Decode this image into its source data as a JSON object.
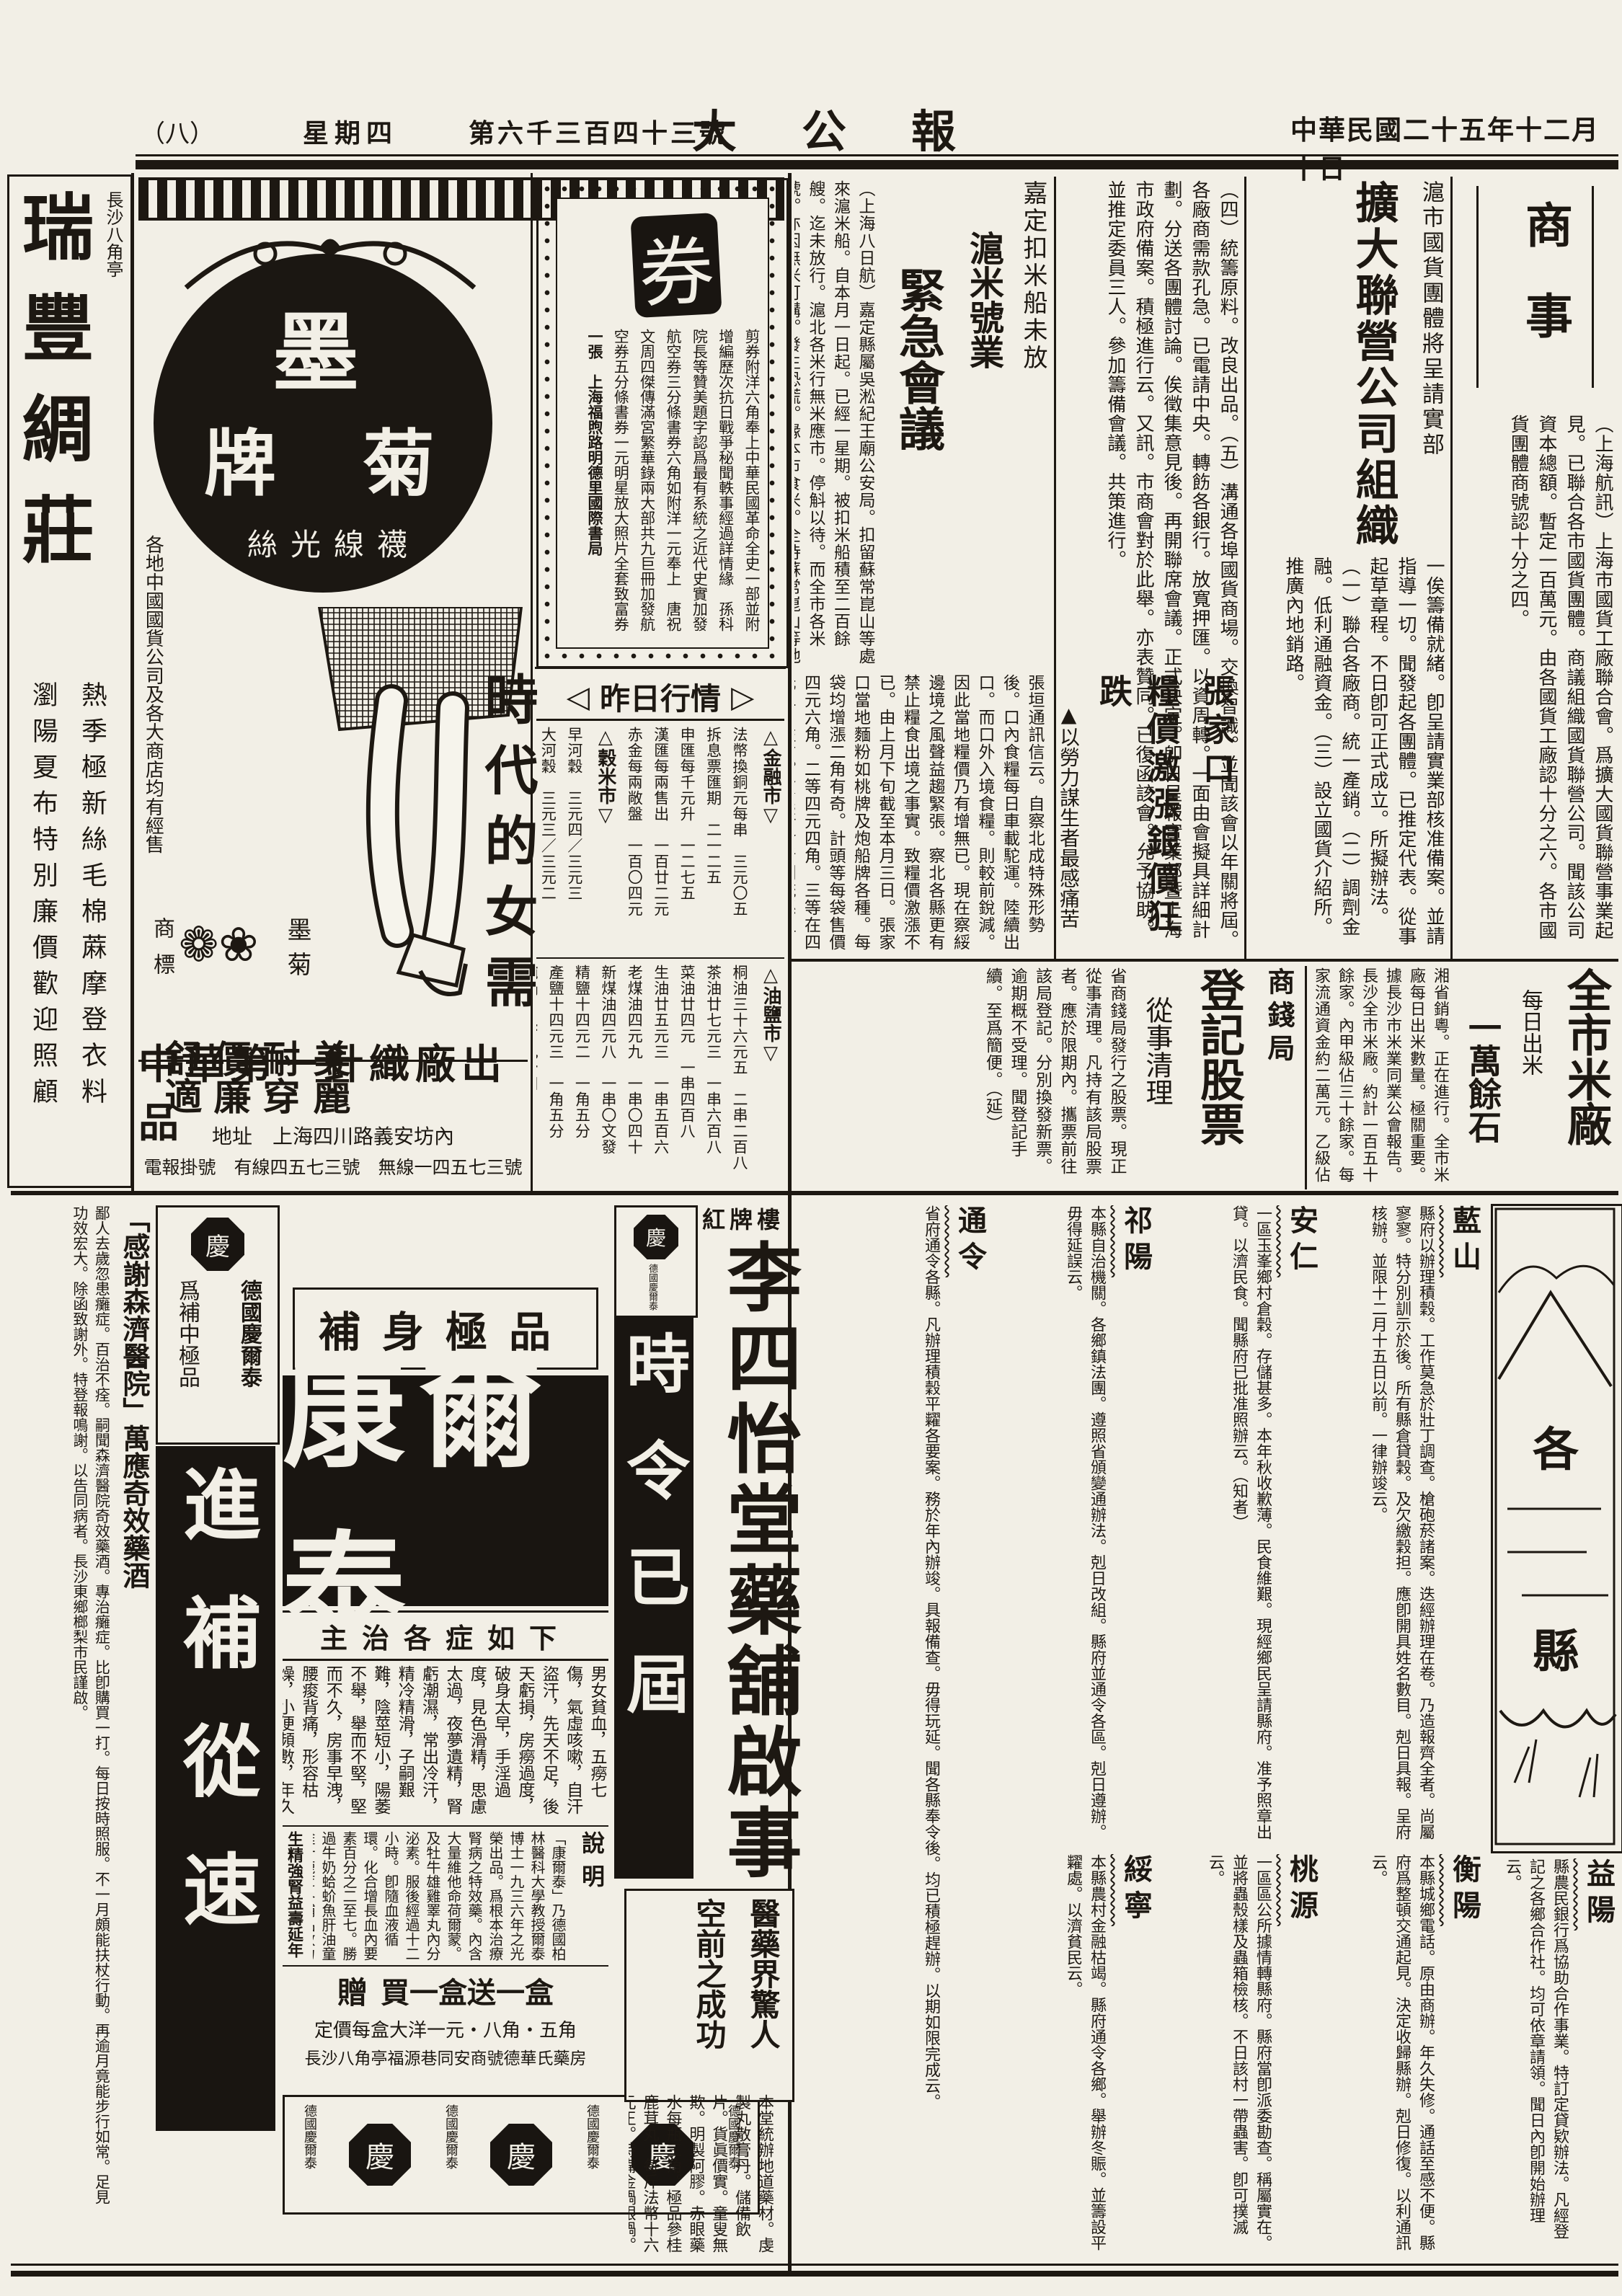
{
  "masthead": {
    "date": "中華民國二十五年十二月十日",
    "title": "大公報",
    "issue": "第六千三百四十三號",
    "weekday": "星期四",
    "page_no": "（八）"
  },
  "news": {
    "section_label": "商事",
    "guohuo": {
      "kicker": "滬市國貨團體將呈請實部",
      "headline": "擴大聯營公司組織",
      "body1": "（上海航訊）上海市國貨工廠聯合會。爲擴大國貨聯營事業起見。已聯合各市國貨團體。商議組織國貨聯營公司。聞該公司資本總額。暫定一百萬元。由各國貨工廠認十分之六。各市國貨團體商號認十分之四。",
      "body2": "一俟籌備就緒。卽呈請實業部核准備案。並請指導一切。聞發起各團體。已推定代表。從事起草章程。不日卽可正式成立。所擬辦法。（一）聯合各廠商。統一產銷。（二）調劑金融。低利通融資金。（三）設立國貨介紹所。推廣內地銷路。",
      "body3": "（四）統籌原料。改良出品。（五）溝通各埠國貨商場。交換智識。並聞該會以年關將屆。各廠商需款孔急。已電請中央。轉飭各銀行。放寬押匯。以資周轉。一面由會擬具詳細計劃。分送各團體討論。俟徵集意見後。再開聯席會議。正式決定。卽日呈報實業部暨上海市政府備案。積極進行云。又訊。市商會對於此舉。亦表贊同。已復函該會。允予協助。並推定委員三人。參加籌備會議。共策進行。"
    },
    "jiading": {
      "kicker": "嘉定扣米船未放",
      "head1": "滬米號業",
      "head2": "緊急會議",
      "body": "（上海八日航）嘉定縣屬吳淞紀王廟公安局。扣留蘇常崑山等處來滬米船。自本月一日起。已經一星期。被扣米船積至二百餘艘。迄未放行。滬北各米行無米應市。停斛以待。而全市各米號。亦因無米可購。發生恐慌。緣本市食米。全恃蘇常崑山等地源源運濟。米號向行家躉進。轉應門市之需。茲聞鐵交部代表。曁米業等代表顧馨一陸槃生蔣石稚等。於今晨乘京滬早車赴鎮。向省政府請願。請爲公決放行。以維民食云。"
    },
    "zhangjiakou": {
      "kicker": "張家口",
      "headline": "糧價激漲銀價狂跌",
      "deck": "▲以勞力謀生者最感痛苦",
      "body": "張垣通訊信云。自察北成特殊形勢後。口內食糧每日車載駝運。陸續出口。而口外入境食糧。則較前銳減。因此當地糧價乃有增無已。現在察綏邊境之風聲益趨緊張。察北各縣更有禁止糧食出境之事實。致糧價激漲不已。由上月下旬截至本月三日。張家口當地麵粉如桃牌及炮船牌各種。每袋均增漲二角有奇。計頭等每袋售價四元六角。二等四元四角。三等在四元二角左右。貧民所食者則統係粗糧。如小米蕎麵及玉米麵等。現亦增漲不已。至於銀元。每元換銅子四百文。較前跌落甚鉅。一般以勞力謀生活者。每日辛勤所入。卽僅可餬口。有室家者。則不能免凍餒矣。"
    },
    "michang": {
      "headline": "全市米廠",
      "kicker": "每日出米",
      "sub": "一萬餘石",
      "body": "湘省銷粵。正在進行。全市米廠每日出米數量。極關重要。據長沙市米業同業公會報告。長沙全市米廠。約計一百五十餘家。內甲級佔三十餘家。每家流通資金約二萬元。乙級佔七十餘家。每家流動資金一萬元。丙級佔五十餘家。每家五千餘元。全市米廠每日儘日夜之力。可出米一萬六千餘石。大部份銷場以滬漢爲最。本市每日銷售二千石上下。本月份因滬漢粵銷場活潑。故平均每日約出米一萬石左右。（廷）"
    },
    "shangqianju": {
      "kicker": "商錢局",
      "headline": "登記股票",
      "deck": "從事清理",
      "body": "省商錢局發行之股票。現正從事清理。凡持有該局股票者。應於限期內。攜票前往該局登記。分別換發新票。逾期概不受理。聞登記手續。至爲簡便。（延）"
    }
  },
  "market": {
    "marker_left": "◁",
    "title": "昨日行情",
    "marker_right": "▷",
    "sections": [
      {
        "name": "△金融市▽",
        "rows": [
          "法幣換銅元每串　三元〇五",
          "拆息票匯期　二一二五",
          "申匯每千元升　一二七五",
          "漢匯每兩售出　一百廿二元",
          "赤金每兩敞盤　一百〇四元"
        ]
      },
      {
        "name": "△穀米市▽",
        "rows": [
          "早河穀　三元四／三元三",
          "大河穀　三元三／三元二",
          "中穀　石三元三／三元二",
          "上米　七元六／七元四",
          "齊米　六元四／五元六",
          "糯米　八元四／八元二",
          "機米　八元四／八元二"
        ]
      },
      {
        "name": "△油鹽市▽",
        "rows": [
          "桐油三十六元五　二串二百八",
          "茶油廿七元三　一串六百八",
          "菜油廿四元　一串四百八",
          "生油廿五元三　一串五百六",
          "老煤油四元九　一串〇四十",
          "新煤油四元八　一串〇文發",
          "精鹽十四元二　一角五分",
          "產鹽十四元三　一角五分"
        ]
      }
    ],
    "footer_rows": [
      "純鍋　五百九十四",
      "鍋卷　七元三百二",
      "生鍋　無市"
    ]
  },
  "coupon": {
    "stamp": "券",
    "lines": [
      "剪券附洋六角奉上中華民國革命全史一部並附",
      "增編歷次抗日戰爭秘聞軼事經過詳情緣　孫科",
      "院長等贊美題字認爲最有系統之近代史實加發",
      "航空券三分條書券六角如附洋一元奉上　唐祝",
      "文周四傑傳滿宮繁華錄兩大部共九巨冊加發航",
      "空券五分條書券一元明星放大照片全套致富券",
      "一張　上海福煦路明德里國際書局"
    ]
  },
  "counties": {
    "header": "各縣",
    "items": [
      {
        "name": "藍山",
        "body": "縣府以辦理積穀。工作莫急於壯丁調查。槍砲菸諸案。迭經辦理在卷。乃造報齊全者。尚屬寥寥。特分別訓示於後。所有縣倉貸穀。及欠繳穀担。應卽開具姓名數目。剋日具報。呈府核辦。並限十二月十五日以前。一律辦竣云。"
      },
      {
        "name": "安仁",
        "body": "一區玉峯鄉村倉穀。存儲甚多。本年秋收歉薄。民食維艱。現經鄉民呈請縣府。准予照章出貸。以濟民食。聞縣府已批准照辦云。（知者）"
      },
      {
        "name": "祁陽",
        "body": "本縣自治機關。各鄉鎮法團。遵照省頒變通辦法。剋日改組。縣府並通令各區。剋日遵辦。毋得延誤云。"
      },
      {
        "name": "通令",
        "body": "省府通令各縣。凡辦理積穀平糶各要案。務於年內辦竣。具報備查。毋得玩延。聞各縣奉令後。均已積極趕辦。以期如限完成云。"
      },
      {
        "name": "益陽",
        "body": "縣農民銀行爲協助合作事業。特訂定貸欵辦法。凡經登記之各鄉合作社。均可依章請領。聞日內卽開始辦理云。"
      },
      {
        "name": "衡陽",
        "body": "本縣城鄉電話。原由商辦。年久失修。通話至感不便。縣府爲整頓交通起見。決定收歸縣辦。剋日修復。以利通訊云。"
      },
      {
        "name": "桃源",
        "body": "一區區公所據情轉縣府。縣府當卽派委勘查。稱屬實在。並將蟲殼樣及蟲箱檢核。不日該村一帶蟲害。卽可撲滅云。"
      },
      {
        "name": "綏寧",
        "body": "本縣農村金融枯竭。縣府通令各鄉。舉辦冬賑。並籌設平糶處。以濟貧民云。"
      }
    ]
  },
  "ads": {
    "ruifeng": {
      "title": "瑞豐綢莊",
      "location": "長沙八角亭",
      "line_right": "熱季極新絲毛棉蔴摩登衣料",
      "line_left": "瀏陽夏布特別廉價歡迎照顧"
    },
    "moju": {
      "char_top": "墨",
      "char_right": "菊",
      "char_left": "牌",
      "product": "絲光線襪",
      "slogan": "時代的女需",
      "s1": "美麗",
      "s2": "耐穿",
      "s3": "價廉",
      "s4": "舒適",
      "trademark_label": "商標",
      "trademark_name": "墨菊",
      "flowers": "❁❀",
      "sellers": "各地中國國貨公司及各大商店均有經售",
      "maker": "中華第一針織廠出品",
      "address": "地址　上海四川路義安坊內",
      "telegraph": "電報掛號　有線四五七三號　無線一四五七三號"
    },
    "lisitang": {
      "location": "紅牌樓",
      "title": "李四怡堂藥舖啟事",
      "body": "本堂統辦地道藥材。虔製丸散膏丹。儲備飲片。貨眞價實。童叟無欺。明製阿膠。赤眼藥水每瓶三角。極品參桂鹿茸丸。每斤法幣十六元正。特備金鍋銀鍋。聽憑選擇製用。凡蒙賜顧。格外歡迎。電話五百十六號。",
      "s1": "醫藥界驚人",
      "s2": "空前之成功"
    },
    "kangertai": {
      "header": "補身極品",
      "name": "康爾泰",
      "subhead": "主治各症如下",
      "symptoms": "男女貧血，五癆七傷，氣虛咳嗽，自汗盜汗，先天不足，後天虧損，房癆過度，破身太早，手淫過度，見色滑精，思慮太過，夜夢遺精，腎虧潮濕，常出冷汗，精冷精滑，子嗣艱難，陰莖短小，陽萎不舉，舉而不堅，堅而不久，房事早洩，腰痠背痛，形容枯燥，小便頻數，年久白濁，頭迷頭暈，四肢無力，腦衰健忘，失眠不睡，耳聾耳鳴，性慾減退，諸虛百損。",
      "note_label": "說明",
      "note": "「康爾泰」乃德國柏林醫科大學教授爾泰博士一九三六年之光榮出品。爲根本治療腎病之特效藥。內含大量維他命荷爾蒙。及牡牛雄雞睪丸內分泌素。服後經過十二小時。卽隨血液循環。化合增長血內要素百分之二至七。勝過牛奶蛤蚧魚肝油童雞汁鹿茸各補品效力之一倍或二倍。誠科學治療。營養人體滋補之極品。",
      "claim": "生精強腎益壽延年",
      "gift": "贈",
      "offer": "買一盒送一盒",
      "price": "定價每盒大洋一元・八角・五角",
      "seller": "長沙八角亭福源巷同安商號德華氏藥房",
      "brand": "德國慶爾泰",
      "medallion": "慶"
    },
    "jinbu": {
      "banner": "進補從速",
      "brand": "德國慶爾泰",
      "sub": "爲補中極品"
    },
    "shiling": {
      "banner": "時令已屆",
      "brand": "德國慶爾泰"
    },
    "ganxie": {
      "title": "「感謝森濟醫院」萬應奇效藥酒",
      "body": "鄙人去歲忽患癱症。百治不痊。嗣聞森濟醫院奇效藥酒。專治癱症。比卽購買一打。每日按時照服。不一月頗能扶杖行動。再逾月竟能步行如常。足見功效宏大。除函致謝外。特登報鳴謝。以告同病者。長沙東鄉榔梨市民謹啟。"
    }
  }
}
